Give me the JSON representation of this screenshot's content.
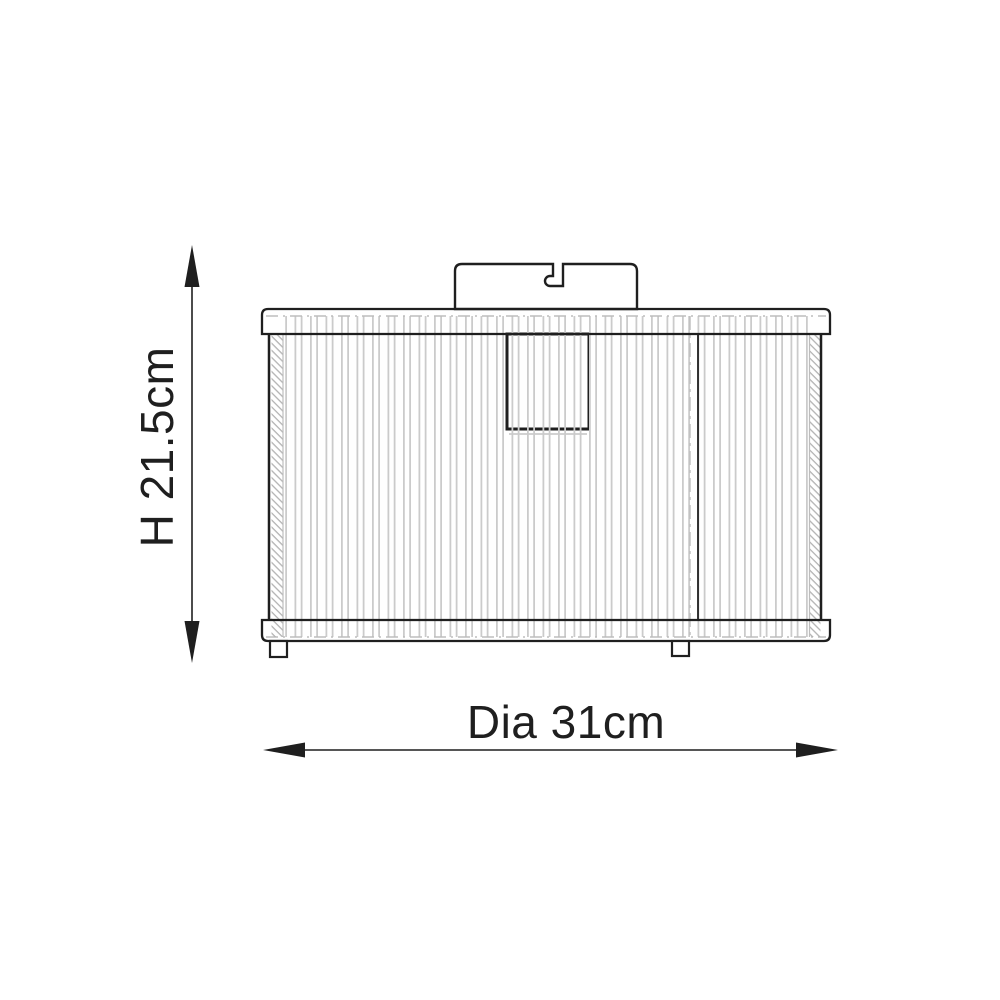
{
  "diagram": {
    "type": "product-dimension-drawing",
    "height_dimension": {
      "label": "H 21.5cm",
      "value_cm": 21.5,
      "orientation": "vertical"
    },
    "diameter_dimension": {
      "label": "Dia 31cm",
      "value_cm": 31,
      "orientation": "horizontal"
    }
  },
  "colors": {
    "background": "#ffffff",
    "outline": "#1f1f1f",
    "rib_gray": "#cbcbcb",
    "hatch_gray": "#b3b3b3",
    "centerline_gray": "#bdbdbd"
  }
}
